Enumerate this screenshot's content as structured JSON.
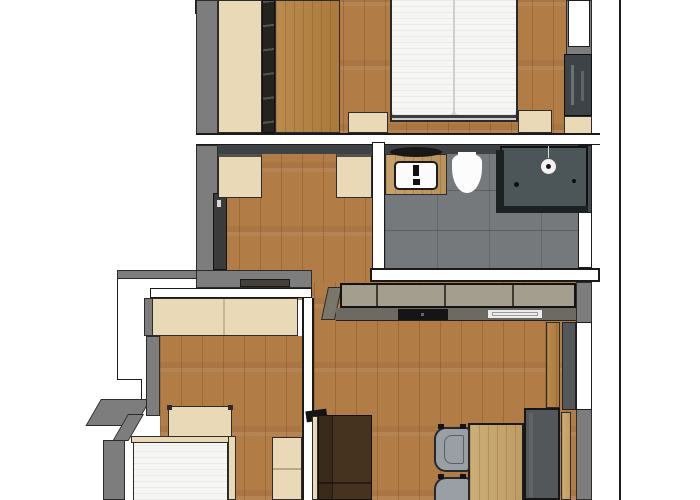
{
  "scene": {
    "type": "apartment-floor-plan-3d-top-view",
    "description": "Rendered top-down 3D floor plan of an apartment with two bedrooms, bathroom, hallway and open living room with kitchen and dining set",
    "colors": {
      "background": "#ffffff",
      "outline": "#1c1c1c",
      "wall_gray": "#7d7d7d",
      "wall_dark": "#3f4244",
      "wood_floor": "#b27c47",
      "furniture_light": "#ead9b6",
      "wood_brown": "#b5813f",
      "vanity_wood": "#c49a62",
      "bath_floor": "#75797b",
      "shower_glass": "#1c2122",
      "kitchen_front": "#a49e8e",
      "countertop": "#6d6963",
      "cooktop": "#151515",
      "sofa_brown": "#46331f",
      "bench_gray": "#53575a",
      "chair_gray": "#999fa4",
      "table_wood": "#c9a76b",
      "mattress_white": "#f6f6f4",
      "door_wood": "#b5803f"
    },
    "rooms": [
      {
        "id": "bedroom-main",
        "label": "Main bedroom with double bed",
        "furniture": [
          "wardrobe",
          "ladder-shelf",
          "double-bed",
          "nightstand-left",
          "nightstand-right",
          "window",
          "wall-cabinet",
          "wall-shelf"
        ]
      },
      {
        "id": "bathroom",
        "label": "Bathroom",
        "furniture": [
          "vanity-washbasin",
          "round-mirror",
          "toilet",
          "corner-shower",
          "door-opening"
        ]
      },
      {
        "id": "hallway",
        "label": "Hallway",
        "furniture": [
          "cabinet-left",
          "cabinet-right",
          "entry-niche",
          "doormat"
        ]
      },
      {
        "id": "bedroom-second",
        "label": "Second bedroom with single bed",
        "furniture": [
          "sliding-wardrobe",
          "bed",
          "headboard",
          "nightstand"
        ]
      },
      {
        "id": "living-kitchen",
        "label": "Living room with kitchen and dining area",
        "furniture": [
          "kitchen-counter",
          "cooktop",
          "kitchen-sink",
          "sofa",
          "tv",
          "dining-table",
          "chair",
          "chair",
          "corner-bench",
          "entrance-door"
        ]
      }
    ]
  }
}
